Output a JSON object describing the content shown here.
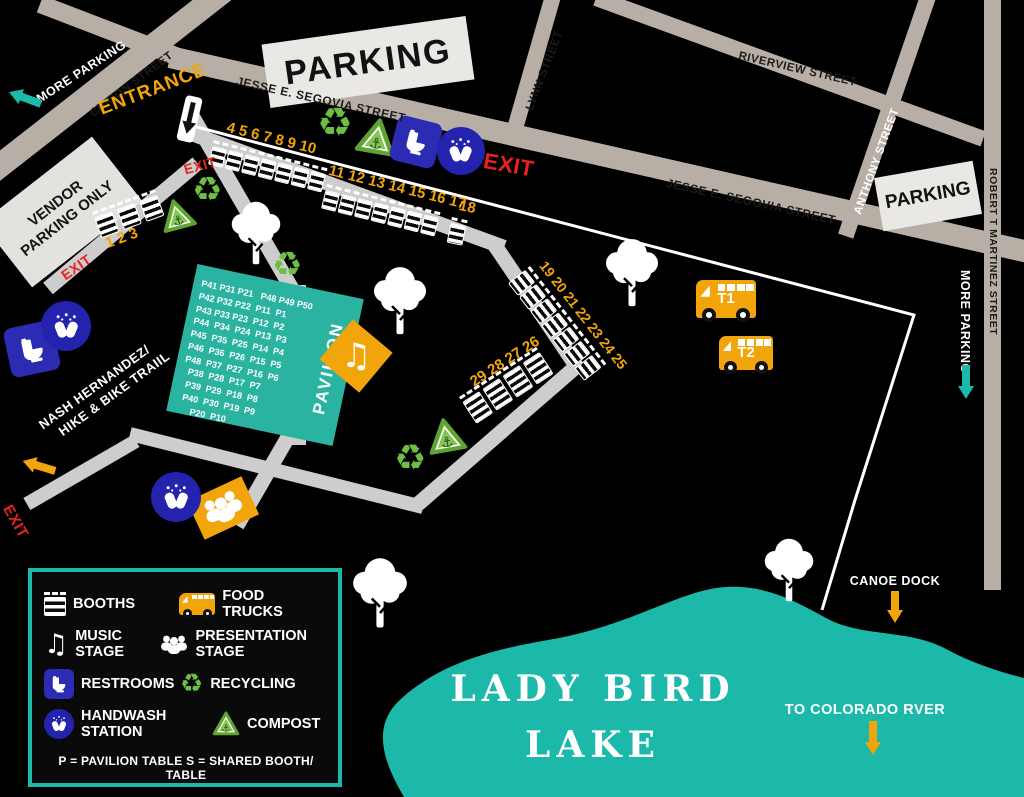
{
  "colors": {
    "background": "#000000",
    "street": "#b7aea6",
    "internal_path": "#cdcdcd",
    "parking_box": "#e9e8e5",
    "teal": "#1cb8a9",
    "yellow": "#f2a50a",
    "red": "#e9221f",
    "blue": "#2b2bb3",
    "green": "#6cbe45"
  },
  "streets": {
    "chicon": "CHICON STREET",
    "jesse_segovia": "JESSE E. SEGOVIA STREET",
    "lynn": "LYNN STREET",
    "riverview": "RIVERVIEW STREET",
    "anthony": "ANTHONY STREET",
    "robert_t_martinez": "ROBERT T MARTINEZ STREET"
  },
  "labels": {
    "parking": "PARKING",
    "more_parking": "MORE PARKING",
    "vendor_line1": "VENDOR",
    "vendor_line2": "PARKING ONLY",
    "entrance": "ENTRANCE",
    "exit": "EXIT",
    "trail_line1": "NASH HERNANDEZ/",
    "trail_line2": "HIKE & BIKE TRAIIL",
    "canoe_dock": "CANOE DOCK",
    "to_colorado": "TO COLORADO RVER",
    "lake_line1": "LADY BIRD",
    "lake_line2": "LAKE"
  },
  "pavilion": {
    "name": "PAVILION",
    "rows": [
      "P41 P31 P21   P48 P49 P50",
      "P42 P32 P22  P11  P1",
      "P43 P33 P23  P12  P2",
      "P44  P34  P24  P13  P3",
      "P45  P35  P25  P14  P4",
      "P46  P36  P26  P15  P5",
      "P48  P37  P27  P16  P6",
      "  P38  P28  P17  P7",
      "  P39  P29  P18  P8",
      "  P40  P30  P19  P9",
      "      P20  P10"
    ]
  },
  "booth_groups": [
    {
      "numbers": "1 2 3"
    },
    {
      "numbers": "4 5 6 7 8 9 10"
    },
    {
      "numbers": "11 12 13 14 15 16 17"
    },
    {
      "numbers": "18"
    },
    {
      "numbers": "19 20 21 22 23 24 25"
    },
    {
      "numbers": "29 28 27 26"
    }
  ],
  "food_trucks": [
    {
      "label": "T1"
    },
    {
      "label": "T2"
    }
  ],
  "legend": {
    "items": [
      {
        "icon": "booth-icon",
        "label": "BOOTHS"
      },
      {
        "icon": "food-truck-icon",
        "label": "FOOD TRUCKS"
      },
      {
        "icon": "music-note-icon",
        "label": "MUSIC STAGE"
      },
      {
        "icon": "people-icon",
        "label": "PRESENTATION STAGE"
      },
      {
        "icon": "restroom-icon",
        "label": "RESTROOMS"
      },
      {
        "icon": "recycling-icon",
        "label": "RECYCLING"
      },
      {
        "icon": "handwash-icon",
        "label": "HANDWASH STATION"
      },
      {
        "icon": "compost-icon",
        "label": "COMPOST"
      }
    ],
    "note": "P = PAVILION TABLE   S = SHARED BOOTH/ TABLE"
  }
}
